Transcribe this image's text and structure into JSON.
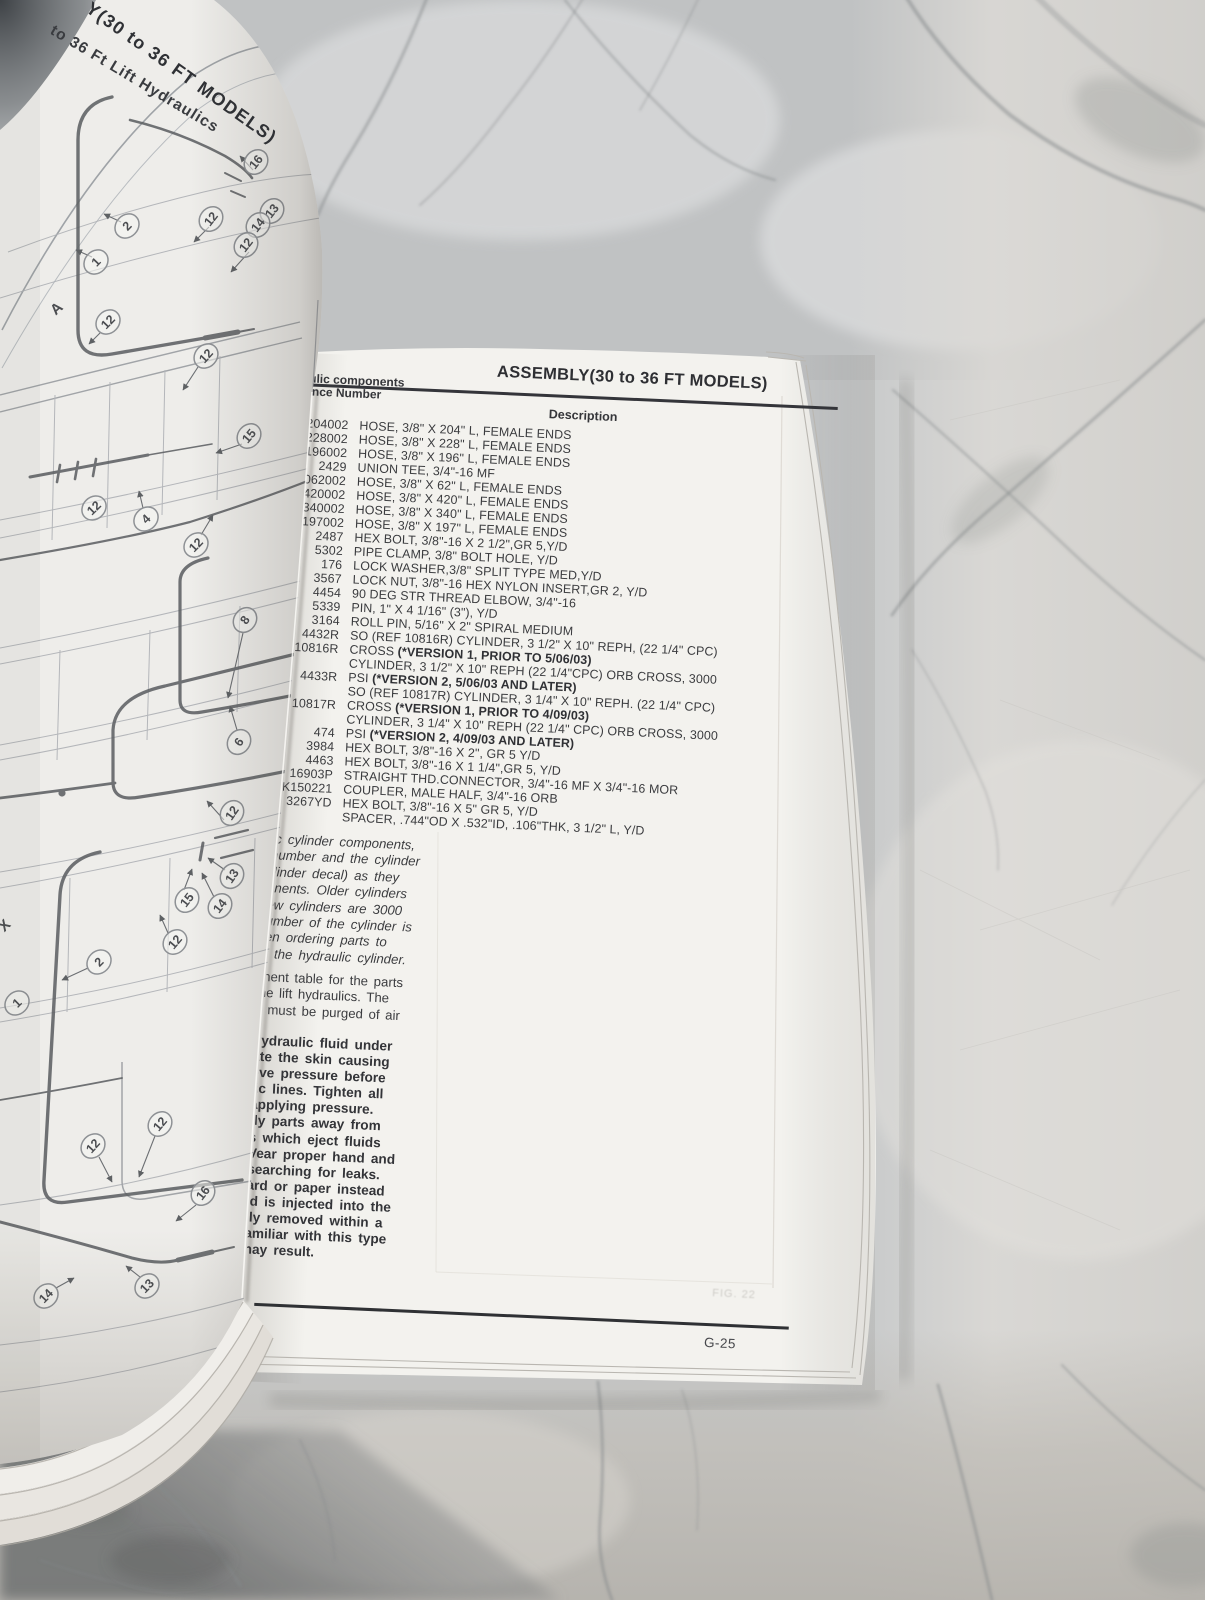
{
  "scene": {
    "description": "open parts manual lying on marble countertop",
    "marble_base_color": "#c7c9ca",
    "page_color": "#f3f2ee",
    "text_color": "#3a3b3e"
  },
  "left_page": {
    "rotated_title_1": "Y(30 to 36 FT MODELS)",
    "rotated_title_2": "to 36 Ft Lift Hydraulics",
    "callouts": [
      {
        "n": "16",
        "x": 256,
        "y": 162,
        "r": -52
      },
      {
        "n": "13",
        "x": 272,
        "y": 211,
        "r": -52
      },
      {
        "n": "14",
        "x": 258,
        "y": 225,
        "r": -52
      },
      {
        "n": "12",
        "x": 246,
        "y": 245,
        "r": -52
      },
      {
        "n": "12",
        "x": 211,
        "y": 219,
        "r": -52
      },
      {
        "n": "2",
        "x": 127,
        "y": 226,
        "r": -46
      },
      {
        "n": "1",
        "x": 96,
        "y": 262,
        "r": -46
      },
      {
        "n": "A",
        "x": 57,
        "y": 309,
        "r": -42,
        "plain": true
      },
      {
        "n": "12",
        "x": 108,
        "y": 322,
        "r": -46
      },
      {
        "n": "12",
        "x": 206,
        "y": 356,
        "r": -48
      },
      {
        "n": "15",
        "x": 249,
        "y": 436,
        "r": -50
      },
      {
        "n": "12",
        "x": 94,
        "y": 508,
        "r": -44
      },
      {
        "n": "4",
        "x": 146,
        "y": 519,
        "r": -44
      },
      {
        "n": "12",
        "x": 196,
        "y": 545,
        "r": -46
      },
      {
        "n": "8",
        "x": 245,
        "y": 620,
        "r": -55
      },
      {
        "n": "6",
        "x": 239,
        "y": 742,
        "r": -55
      },
      {
        "n": "12",
        "x": 232,
        "y": 813,
        "r": -55
      },
      {
        "n": "13",
        "x": 232,
        "y": 876,
        "r": -55
      },
      {
        "n": "15",
        "x": 187,
        "y": 900,
        "r": -52
      },
      {
        "n": "14",
        "x": 220,
        "y": 906,
        "r": -52
      },
      {
        "n": "X",
        "x": 5,
        "y": 926,
        "r": -45,
        "plain": true
      },
      {
        "n": "12",
        "x": 175,
        "y": 942,
        "r": -50
      },
      {
        "n": "2",
        "x": 99,
        "y": 962,
        "r": -45
      },
      {
        "n": "1",
        "x": 17,
        "y": 1003,
        "r": -45
      },
      {
        "n": "12",
        "x": 160,
        "y": 1124,
        "r": -50
      },
      {
        "n": "12",
        "x": 93,
        "y": 1146,
        "r": -48
      },
      {
        "n": "16",
        "x": 203,
        "y": 1193,
        "r": -52
      },
      {
        "n": "13",
        "x": 147,
        "y": 1286,
        "r": -46
      },
      {
        "n": "14",
        "x": 46,
        "y": 1296,
        "r": -46
      }
    ]
  },
  "right_page": {
    "ref_header_line1": "draulic components",
    "ref_header_line2": "ference Number",
    "title": "ASSEMBLY(30 to 36 FT MODELS)",
    "description_header": "Description",
    "parts": [
      {
        "ref": "4204002",
        "d": "HOSE, 3/8\" X 204\" L, FEMALE ENDS"
      },
      {
        "ref": "4228002",
        "d": "HOSE, 3/8\" X 228\" L, FEMALE ENDS"
      },
      {
        "ref": "4196002",
        "d": "HOSE, 3/8\" X 196\" L, FEMALE ENDS"
      },
      {
        "ref": "2429",
        "d": "UNION TEE, 3/4\"-16 MF"
      },
      {
        "ref": "4062002",
        "d": "HOSE, 3/8\" X 62\" L, FEMALE ENDS"
      },
      {
        "ref": "4420002",
        "d": "HOSE, 3/8\" X 420\" L, FEMALE ENDS"
      },
      {
        "ref": "4340002",
        "d": "HOSE, 3/8\" X 340\" L, FEMALE ENDS"
      },
      {
        "ref": "4197002",
        "d": "HOSE, 3/8\" X 197\" L, FEMALE ENDS"
      },
      {
        "ref": "2487",
        "d": "HEX BOLT, 3/8\"-16 X 2 1/2\",GR 5,Y/D"
      },
      {
        "ref": "5302",
        "d": "PIPE CLAMP, 3/8\" BOLT HOLE, Y/D"
      },
      {
        "ref": "176",
        "d": "LOCK WASHER,3/8\" SPLIT TYPE MED,Y/D"
      },
      {
        "ref": "3567",
        "d": "LOCK NUT, 3/8\"-16 HEX NYLON INSERT,GR 2, Y/D"
      },
      {
        "ref": "4454",
        "d": "90 DEG STR THREAD ELBOW, 3/4\"-16"
      },
      {
        "ref": "5339",
        "d": "PIN, 1\" X 4 1/16\" (3\"), Y/D"
      },
      {
        "ref": "3164",
        "d": "ROLL PIN, 5/16\" X 2\" SPIRAL MEDIUM"
      },
      {
        "ref": "4432R",
        "d": "SO (REF 10816R) CYLINDER, 3 1/2\" X 10\" REPH, (22 1/4\" CPC)"
      },
      {
        "ref": "10816R",
        "d": "CROSS ",
        "b": "(*VERSION 1, PRIOR TO 5/06/03)"
      },
      {
        "ref": "",
        "d": "CYLINDER, 3 1/2\" X 10\" REPH (22 1/4\"CPC) ORB CROSS, 3000"
      },
      {
        "ref": "4433R",
        "d": "PSI ",
        "b": "(*VERSION 2, 5/06/03 AND LATER)"
      },
      {
        "ref": "",
        "d": "SO (REF 10817R) CYLINDER, 3 1/4\" X 10\" REPH. (22 1/4\" CPC)"
      },
      {
        "ref": "10817R",
        "d": "CROSS ",
        "b": "(*VERSION 1, PRIOR TO 4/09/03)"
      },
      {
        "ref": "",
        "d": "CYLINDER, 3 1/4\" X 10\" REPH (22 1/4\" CPC) ORB CROSS, 3000"
      },
      {
        "ref": "474",
        "d": "PSI ",
        "b": "(*VERSION 2, 4/09/03 AND LATER)"
      },
      {
        "ref": "3984",
        "d": "HEX BOLT, 3/8\"-16 X 2\", GR 5 Y/D"
      },
      {
        "ref": "4463",
        "d": "HEX BOLT, 3/8\"-16 X 1 1/4\",GR 5, Y/D"
      },
      {
        "ref": "16903P",
        "d": "STRAIGHT THD.CONNECTOR, 3/4\"-16 MF X 3/4\"-16 MOR"
      },
      {
        "ref": "K150221",
        "d": "COUPLER, MALE HALF, 3/4\"-16 ORB"
      },
      {
        "ref": "3267YD",
        "d": "HEX BOLT, 3/8\"-16 X 5\" GR 5,  Y/D"
      },
      {
        "ref": "",
        "d": "SPACER, .744\"OD X .532\"ID, .106\"THK, 3 1/2\" L, Y/D"
      }
    ],
    "paragraph1_lines": [
      "ulic cylinder components,",
      "t number and the cylinder",
      "cylinder decal) as they",
      "ponents.  Older  cylinders",
      "new cylinders are 3000",
      "number of the cylinder is",
      "hen  ordering  parts  to",
      "of the hydraulic cylinder."
    ],
    "paragraph2_lines": [
      "onent table for the parts",
      "the  lift  hydraulics.  The",
      "d must be purged of air"
    ],
    "paragraph3_lines": [
      "hydraulic fluid under",
      "ate  the  skin  causing",
      "eve  pressure  before",
      "lic  lines.  Tighten  all",
      "applying   pressure.",
      "dy  parts  away  from",
      "s  which  eject  fluids",
      "Vear proper hand and",
      "searching  for  leaks.",
      "ard  or  paper  instead",
      "id is injected into the",
      "lly removed within a",
      "amiliar with this type",
      "nay result."
    ],
    "page_number": "G-25",
    "ghost_text": "FIG. 22"
  }
}
